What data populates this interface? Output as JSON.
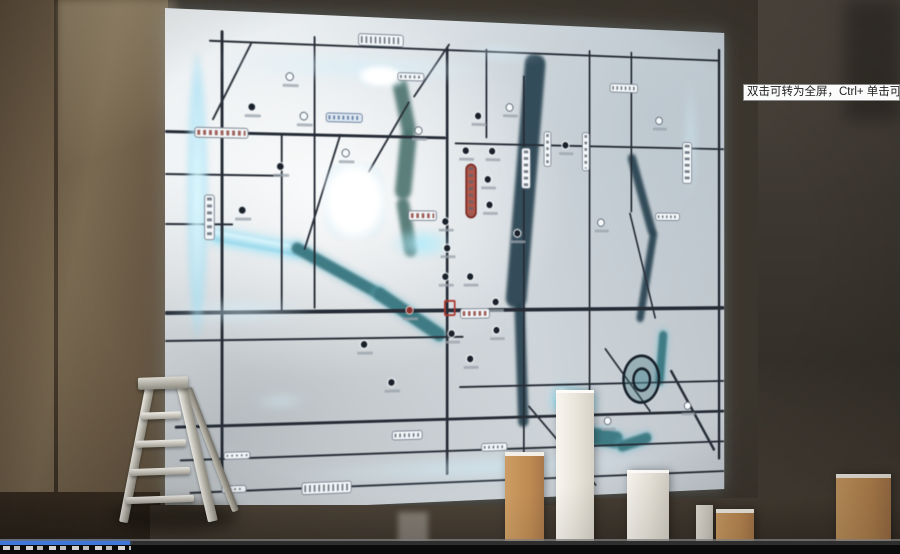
{
  "tooltip": {
    "text": "双击可转为全屏，Ctrl+ 单击可转为"
  },
  "player": {
    "progress_percent": 14.4
  },
  "colors": {
    "progress_blue": "#3f78d8",
    "glow_cyan": "#aee4f5",
    "map_panel": "#e9edf0",
    "road_dark": "#262c36",
    "river_teal": "#3f7b84",
    "wall_brown": "#6b5b46"
  },
  "map": {
    "roads_h": [
      {
        "x": 45,
        "y": 30,
        "w": 580,
        "t": 2
      },
      {
        "x": 0,
        "y": 122,
        "w": 300,
        "t": 3
      },
      {
        "x": 310,
        "y": 128,
        "w": 320,
        "t": 2
      },
      {
        "x": 0,
        "y": 165,
        "w": 120,
        "t": 2
      },
      {
        "x": 0,
        "y": 215,
        "w": 70,
        "t": 2
      },
      {
        "x": 0,
        "y": 303,
        "w": 630,
        "t": 4
      },
      {
        "x": 0,
        "y": 332,
        "w": 320,
        "t": 2
      },
      {
        "x": 315,
        "y": 385,
        "w": 315,
        "t": 2
      },
      {
        "x": 10,
        "y": 418,
        "w": 620,
        "t": 3
      },
      {
        "x": 15,
        "y": 452,
        "w": 615,
        "t": 2
      },
      {
        "x": 25,
        "y": 485,
        "w": 605,
        "t": 2
      }
    ],
    "roads_v": [
      {
        "x": 57,
        "y": 20,
        "h": 455,
        "t": 3
      },
      {
        "x": 155,
        "y": 22,
        "h": 280,
        "t": 2
      },
      {
        "x": 300,
        "y": 28,
        "h": 450,
        "t": 3
      },
      {
        "x": 388,
        "y": 55,
        "h": 415,
        "t": 2
      },
      {
        "x": 465,
        "y": 25,
        "h": 445,
        "t": 2
      },
      {
        "x": 515,
        "y": 25,
        "h": 175,
        "t": 2
      },
      {
        "x": 622,
        "y": 18,
        "h": 455,
        "t": 3
      },
      {
        "x": 345,
        "y": 28,
        "h": 95,
        "t": 2
      },
      {
        "x": 120,
        "y": 122,
        "h": 182,
        "t": 2
      }
    ],
    "diagonals": [
      {
        "x": 260,
        "y": 87,
        "len": 87,
        "a": 121,
        "t": 2
      },
      {
        "x": 305,
        "y": 25,
        "len": 70,
        "a": 125,
        "t": 2
      },
      {
        "x": 565,
        "y": 372,
        "len": 105,
        "a": 59,
        "t": 3
      },
      {
        "x": 485,
        "y": 347,
        "len": 89,
        "a": 52,
        "t": 2
      },
      {
        "x": 395,
        "y": 407,
        "len": 119,
        "a": 48,
        "t": 2
      },
      {
        "x": 90,
        "y": 32,
        "len": 89,
        "a": 117,
        "t": 2
      },
      {
        "x": 185,
        "y": 122,
        "len": 126,
        "a": 108,
        "t": 2
      },
      {
        "x": 515,
        "y": 200,
        "len": 120,
        "a": 75,
        "t": 2
      }
    ],
    "rivers": [
      {
        "x": 48,
        "y": 222,
        "len": 95,
        "a": 10,
        "t": 10,
        "cls": "river-cyan"
      },
      {
        "x": 135,
        "y": 232,
        "len": 110,
        "a": 28,
        "t": 12,
        "cls": "river-teal"
      },
      {
        "x": 225,
        "y": 278,
        "len": 92,
        "a": 33,
        "t": 14,
        "cls": "river-teal"
      },
      {
        "x": 255,
        "y": 60,
        "len": 62,
        "a": 78,
        "t": 16,
        "cls": "river-green"
      },
      {
        "x": 268,
        "y": 118,
        "len": 72,
        "a": 96,
        "t": 18,
        "cls": "river-green"
      },
      {
        "x": 258,
        "y": 186,
        "len": 62,
        "a": 80,
        "t": 14,
        "cls": "river-green"
      },
      {
        "x": 415,
        "y": 33,
        "len": 272,
        "a": 95,
        "t": 24,
        "cls": "river-dark"
      },
      {
        "x": 390,
        "y": 298,
        "len": 132,
        "a": 88,
        "t": 12,
        "cls": "river-dark"
      },
      {
        "x": 520,
        "y": 135,
        "len": 92,
        "a": 73,
        "t": 10,
        "cls": "river-dark"
      },
      {
        "x": 548,
        "y": 220,
        "len": 102,
        "a": 100,
        "t": 9,
        "cls": "river-dark"
      },
      {
        "x": 428,
        "y": 388,
        "len": 46,
        "a": 15,
        "t": 22,
        "cls": "river-cyan"
      },
      {
        "x": 452,
        "y": 430,
        "len": 56,
        "a": 10,
        "t": 18,
        "cls": "river-teal"
      },
      {
        "x": 498,
        "y": 450,
        "len": 42,
        "a": -15,
        "t": 12,
        "cls": "river-teal"
      },
      {
        "x": 560,
        "y": 330,
        "len": 60,
        "a": 95,
        "t": 10,
        "cls": "river-teal"
      }
    ],
    "glows": [
      {
        "x": 22,
        "y": 42,
        "w": 22,
        "h": 290,
        "cls": "glow-strong"
      },
      {
        "x": 48,
        "y": 36,
        "w": 315,
        "h": 32,
        "cls": "glow-soft"
      },
      {
        "x": 166,
        "y": 152,
        "w": 66,
        "h": 78,
        "cls": "glow-bloom"
      },
      {
        "x": 203,
        "y": 50,
        "w": 50,
        "h": 22,
        "cls": "glow-bloom"
      },
      {
        "x": 0,
        "y": 290,
        "w": 155,
        "h": 28,
        "cls": "glow-soft"
      },
      {
        "x": 128,
        "y": 458,
        "w": 430,
        "h": 28,
        "cls": "glow-soft"
      },
      {
        "x": 580,
        "y": 50,
        "w": 16,
        "h": 135,
        "cls": "glow-soft"
      },
      {
        "x": 316,
        "y": 24,
        "w": 95,
        "h": 16,
        "cls": "glow-soft"
      },
      {
        "x": 238,
        "y": 218,
        "w": 70,
        "h": 34,
        "cls": "glow-cyan"
      },
      {
        "x": 90,
        "y": 388,
        "w": 60,
        "h": 16,
        "cls": "glow-soft"
      }
    ],
    "pois": [
      {
        "x": 332,
        "y": 95
      },
      {
        "x": 368,
        "y": 85,
        "v": "l"
      },
      {
        "x": 318,
        "y": 132
      },
      {
        "x": 348,
        "y": 132
      },
      {
        "x": 343,
        "y": 162
      },
      {
        "x": 345,
        "y": 189
      },
      {
        "x": 295,
        "y": 207
      },
      {
        "x": 297,
        "y": 235
      },
      {
        "x": 377,
        "y": 219
      },
      {
        "x": 323,
        "y": 265
      },
      {
        "x": 295,
        "y": 265
      },
      {
        "x": 352,
        "y": 292
      },
      {
        "x": 433,
        "y": 124
      },
      {
        "x": 475,
        "y": 207,
        "v": "l"
      },
      {
        "x": 140,
        "y": 100,
        "v": "l"
      },
      {
        "x": 115,
        "y": 152
      },
      {
        "x": 185,
        "y": 137,
        "v": "l"
      },
      {
        "x": 75,
        "y": 197
      },
      {
        "x": 265,
        "y": 112,
        "v": "l"
      },
      {
        "x": 443,
        "y": 447
      },
      {
        "x": 483,
        "y": 422,
        "v": "l"
      },
      {
        "x": 353,
        "y": 322
      },
      {
        "x": 302,
        "y": 325
      },
      {
        "x": 323,
        "y": 352
      },
      {
        "x": 125,
        "y": 60,
        "v": "l"
      },
      {
        "x": 85,
        "y": 92
      },
      {
        "x": 580,
        "y": 408,
        "v": "l"
      },
      {
        "x": 545,
        "y": 95,
        "v": "l"
      },
      {
        "x": 255,
        "y": 300,
        "v": "r"
      },
      {
        "x": 205,
        "y": 335
      },
      {
        "x": 235,
        "y": 375
      }
    ],
    "pills": [
      {
        "x": 30,
        "y": 118,
        "w": 56,
        "h": 11,
        "cls": "pill-red"
      },
      {
        "x": 203,
        "y": 17,
        "w": 50,
        "h": 13,
        "cls": "pill-light"
      },
      {
        "x": 246,
        "y": 56,
        "w": 30,
        "h": 9,
        "cls": "pill-light"
      },
      {
        "x": 386,
        "y": 132,
        "w": 11,
        "h": 44,
        "cls": "pill-light v"
      },
      {
        "x": 412,
        "y": 114,
        "w": 9,
        "h": 38,
        "cls": "pill-light v"
      },
      {
        "x": 457,
        "y": 114,
        "w": 9,
        "h": 42,
        "cls": "pill-light v"
      },
      {
        "x": 322,
        "y": 150,
        "w": 13,
        "h": 58,
        "cls": "pill-stadium v"
      },
      {
        "x": 258,
        "y": 200,
        "w": 32,
        "h": 11,
        "cls": "pill-red"
      },
      {
        "x": 316,
        "y": 303,
        "w": 34,
        "h": 11,
        "cls": "pill-red"
      },
      {
        "x": 142,
        "y": 480,
        "w": 54,
        "h": 13,
        "cls": "pill-light"
      },
      {
        "x": 578,
        "y": 122,
        "w": 12,
        "h": 46,
        "cls": "pill-light v"
      },
      {
        "x": 40,
        "y": 186,
        "w": 11,
        "h": 46,
        "cls": "pill-light v"
      },
      {
        "x": 168,
        "y": 100,
        "w": 40,
        "h": 10,
        "cls": "pill-blue"
      },
      {
        "x": 240,
        "y": 430,
        "w": 34,
        "h": 10,
        "cls": "pill-light"
      },
      {
        "x": 60,
        "y": 446,
        "w": 28,
        "h": 8,
        "cls": "pill-light"
      },
      {
        "x": 58,
        "y": 480,
        "w": 26,
        "h": 8,
        "cls": "pill-light"
      },
      {
        "x": 340,
        "y": 446,
        "w": 30,
        "h": 9,
        "cls": "pill-light"
      },
      {
        "x": 490,
        "y": 60,
        "w": 34,
        "h": 10,
        "cls": "pill-light"
      },
      {
        "x": 545,
        "y": 200,
        "w": 30,
        "h": 9,
        "cls": "pill-light"
      }
    ],
    "red_box": {
      "x": 298,
      "y": 294,
      "w": 13,
      "h": 17
    },
    "spiral": {
      "x": 505,
      "y": 355,
      "w": 46,
      "h": 54
    }
  },
  "props": {
    "boxes": [
      {
        "x": 505,
        "y": 452,
        "w": 39,
        "h": 102,
        "cls": "box-tan"
      },
      {
        "x": 556,
        "y": 390,
        "w": 38,
        "h": 164,
        "cls": "box-white"
      },
      {
        "x": 627,
        "y": 470,
        "w": 42,
        "h": 84,
        "cls": "box-white"
      },
      {
        "x": 696,
        "y": 505,
        "w": 17,
        "h": 49,
        "cls": "box-gray"
      },
      {
        "x": 716,
        "y": 509,
        "w": 38,
        "h": 45,
        "cls": "box-tan"
      },
      {
        "x": 836,
        "y": 474,
        "w": 55,
        "h": 80,
        "cls": "box-tan"
      }
    ]
  }
}
